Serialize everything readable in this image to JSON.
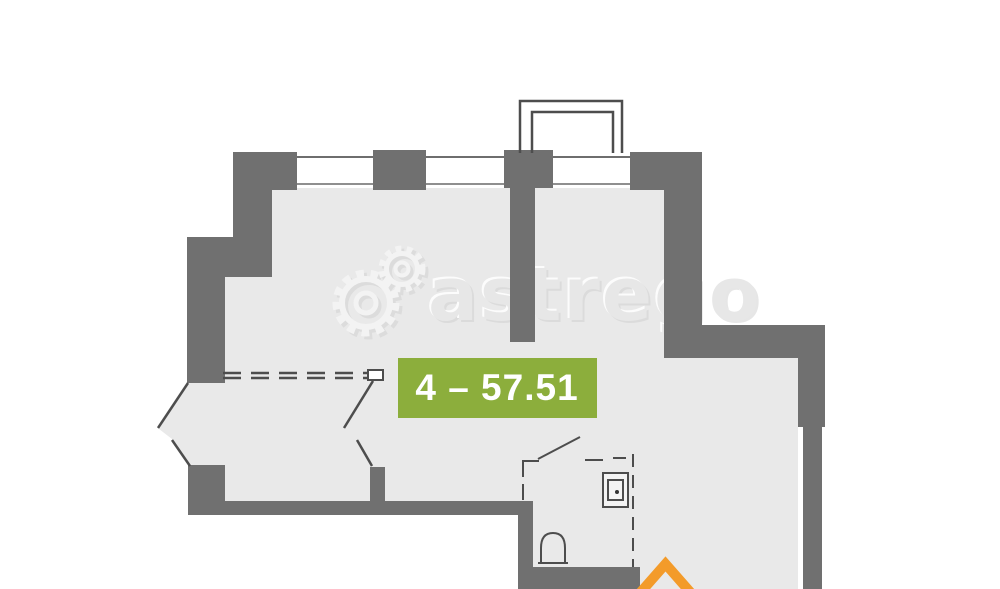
{
  "badge": {
    "label": "4 – 57.51",
    "unit": "4",
    "area_m2": "57.51",
    "background": "#8cae3c",
    "text_color": "#ffffff"
  },
  "watermark": {
    "text": "astrego",
    "logo": "gears-icon"
  },
  "plan": {
    "wall_color": "#707070",
    "floor_color": "#e9e9e9",
    "line_color": "#4d4d4d",
    "window_color": "#ffffff",
    "bottom_logo": "house-chevron-icon",
    "bottom_logo_color": "#f39b2a"
  }
}
